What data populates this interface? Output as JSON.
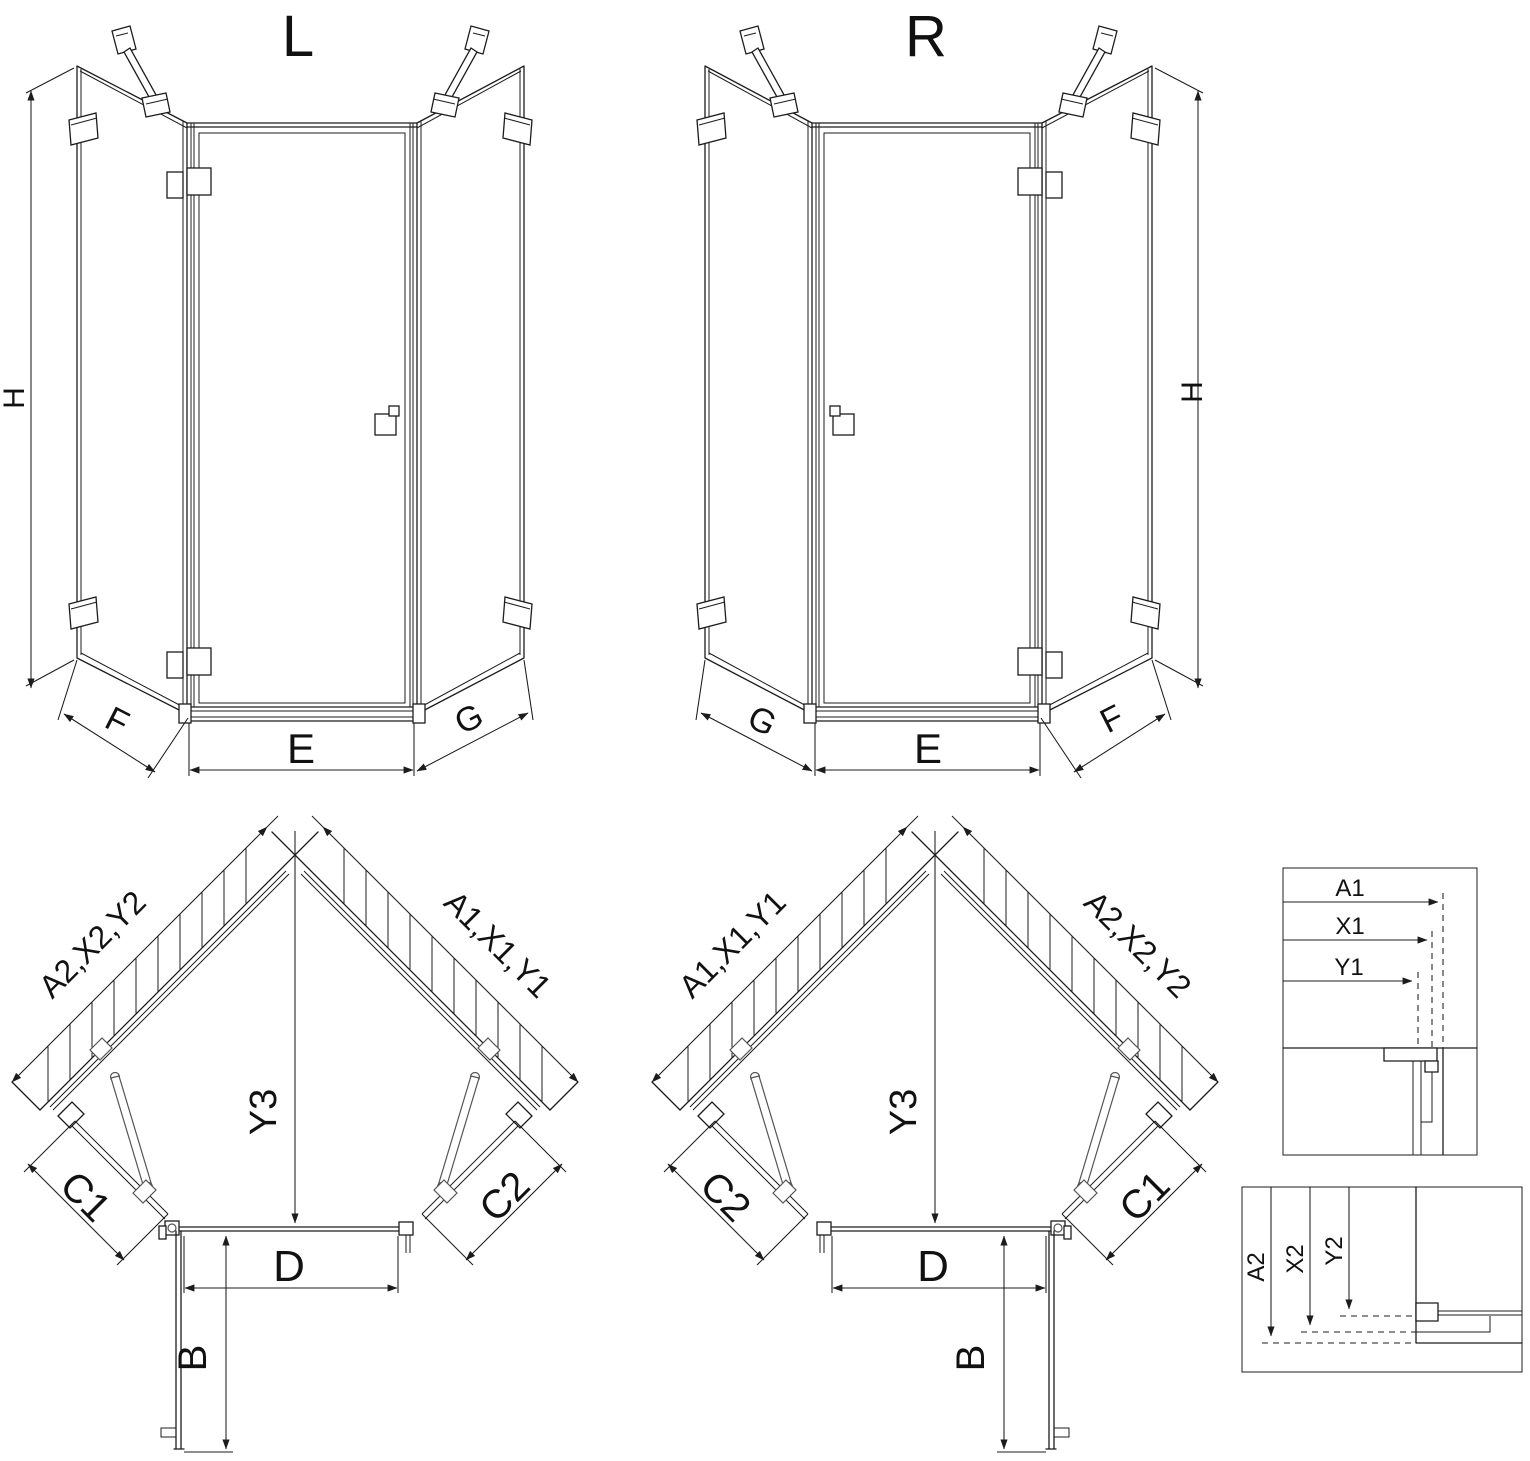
{
  "drawing": {
    "iso_left": {
      "title": "L",
      "dim_height": "H",
      "dim_side_left": "F",
      "dim_front": "E",
      "dim_side_right": "G"
    },
    "iso_right": {
      "title": "R",
      "dim_height": "H",
      "dim_side_left": "G",
      "dim_front": "E",
      "dim_side_right": "F"
    },
    "plan_left": {
      "dim_wall_left": "A2,X2,Y2",
      "dim_wall_right": "A1,X1,Y1",
      "dim_depth": "Y3",
      "dim_panel_left": "C1",
      "dim_panel_right": "C2",
      "dim_door_width": "D",
      "dim_door_open": "B"
    },
    "plan_right": {
      "dim_wall_left": "A1,X1,Y1",
      "dim_wall_right": "A2,X2,Y2",
      "dim_depth": "Y3",
      "dim_panel_left": "C2",
      "dim_panel_right": "C1",
      "dim_door_width": "D",
      "dim_door_open": "B"
    },
    "detail_top": {
      "dim_a": "A1",
      "dim_x": "X1",
      "dim_y": "Y1"
    },
    "detail_bottom": {
      "dim_a": "A2",
      "dim_x": "X2",
      "dim_y": "Y2"
    },
    "colors": {
      "line": "#1c1c1c",
      "background": "#ffffff"
    }
  }
}
